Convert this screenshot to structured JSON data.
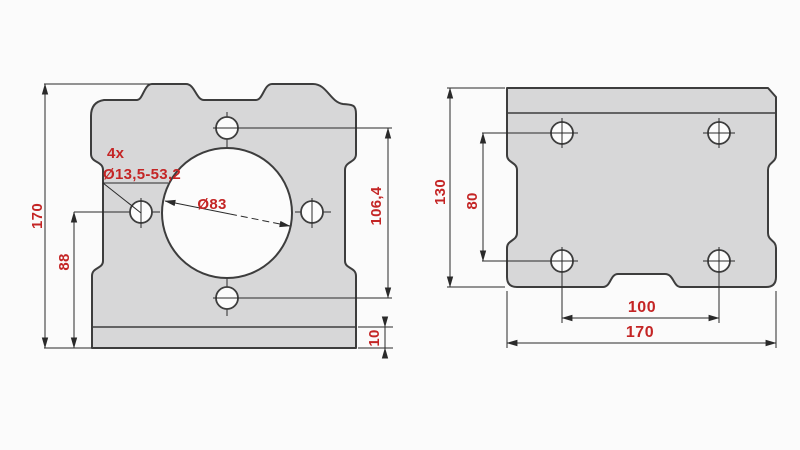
{
  "drawing_title": "motor mount bracket two-view technical drawing",
  "colors": {
    "dimension_text": "#c42525",
    "plate_fill": "#d7d7d8",
    "outline": "#3d3d3d",
    "dimension_line": "#2a2a2a",
    "background": "#fbfbfb"
  },
  "front_view": {
    "dims": {
      "overall_height": "170",
      "hole_row_height_from_base": "88",
      "hole_spacing_vertical": "106,4",
      "base_plate_thickness": "10",
      "center_bore_diameter": "Ø83"
    },
    "hole_callout": {
      "count": "4x",
      "spec": "Ø13,5-53,2"
    }
  },
  "top_view": {
    "dims": {
      "overall_depth": "130",
      "hole_spacing_depth": "80",
      "hole_spacing_width": "100",
      "overall_width": "170"
    }
  }
}
